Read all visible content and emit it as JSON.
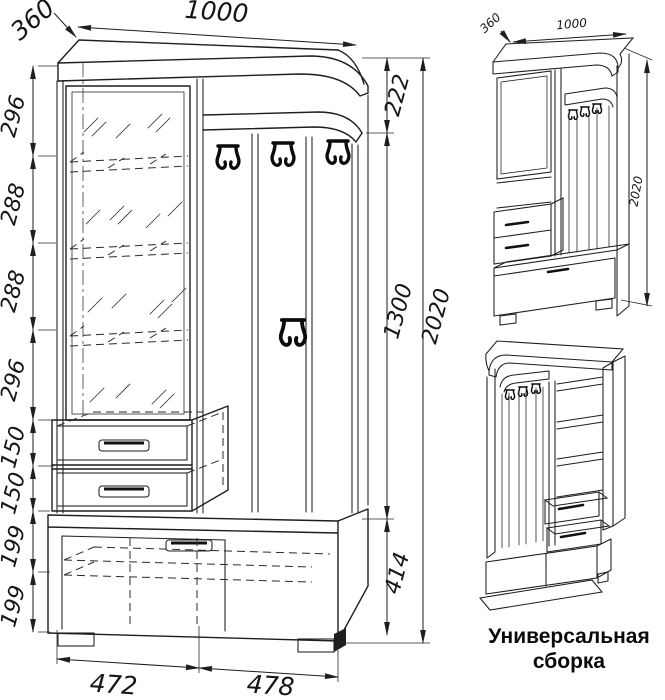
{
  "drawing": {
    "front_view": {
      "width_mm": "1000",
      "depth_mm": "360",
      "left_chain": [
        "296",
        "288",
        "288",
        "296",
        "150",
        "150",
        "199",
        "199"
      ],
      "right_chain": {
        "top": "222",
        "middle": "1300",
        "bottom": "414"
      },
      "total_height": "2020",
      "bottom_left_width": "472",
      "bottom_right_width": "478"
    },
    "iso_view": {
      "depth_mm": "360",
      "width_mm": "1000",
      "height_mm": "2020"
    },
    "caption_line1": "Универсальная",
    "caption_line2": "сборка",
    "colors": {
      "line": "#1e1e1e",
      "background": "#ffffff"
    }
  }
}
